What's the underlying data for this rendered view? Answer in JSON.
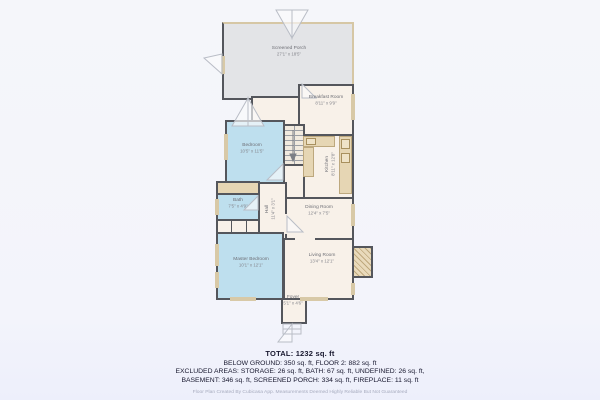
{
  "plan": {
    "rooms": {
      "screened_porch": {
        "name": "Screened Porch",
        "dims": "27'1\" x 18'5\""
      },
      "breakfast": {
        "name": "Breakfast Room",
        "dims": "8'11\" x 9'9\""
      },
      "kitchen": {
        "name": "Kitchen",
        "dims": "8'11\" x 12'8\""
      },
      "bedroom": {
        "name": "Bedroom",
        "dims": "10'5\" x 11'5\""
      },
      "bath": {
        "name": "Bath",
        "dims": "7'5\" x 4'9\""
      },
      "hall": {
        "name": "Hall",
        "dims": "11'4\" x 3'1\""
      },
      "dining": {
        "name": "Dining Room",
        "dims": "12'4\" x 7'5\""
      },
      "living": {
        "name": "Living Room",
        "dims": "13'4\" x 12'1\""
      },
      "master": {
        "name": "Master Bedroom",
        "dims": "10'1\" x 12'1\""
      },
      "foyer": {
        "name": "Foyer",
        "dims": "5'1\" x 4'6\""
      }
    },
    "palette": {
      "wall": "#54565c",
      "carpet_blue": "#bedfee",
      "floor_cream": "#f8f1e9",
      "porch_gray": "#e3e4e7",
      "counter_tan": "#e6d6b4",
      "background": "#f4f5fa"
    }
  },
  "summary": {
    "total": "TOTAL: 1232 sq. ft",
    "line1": "BELOW GROUND: 350 sq. ft, FLOOR 2: 882 sq. ft",
    "line2": "EXCLUDED AREAS: STORAGE: 26 sq. ft, BATH: 67 sq. ft, UNDEFINED: 26 sq. ft,",
    "line3": "BASEMENT: 346 sq. ft, SCREENED PORCH: 334 sq. ft, FIREPLACE: 11 sq. ft",
    "footer": "Floor Plan Created By Cubicasa App. Measurements Deemed Highly Reliable But Not Guaranteed"
  }
}
